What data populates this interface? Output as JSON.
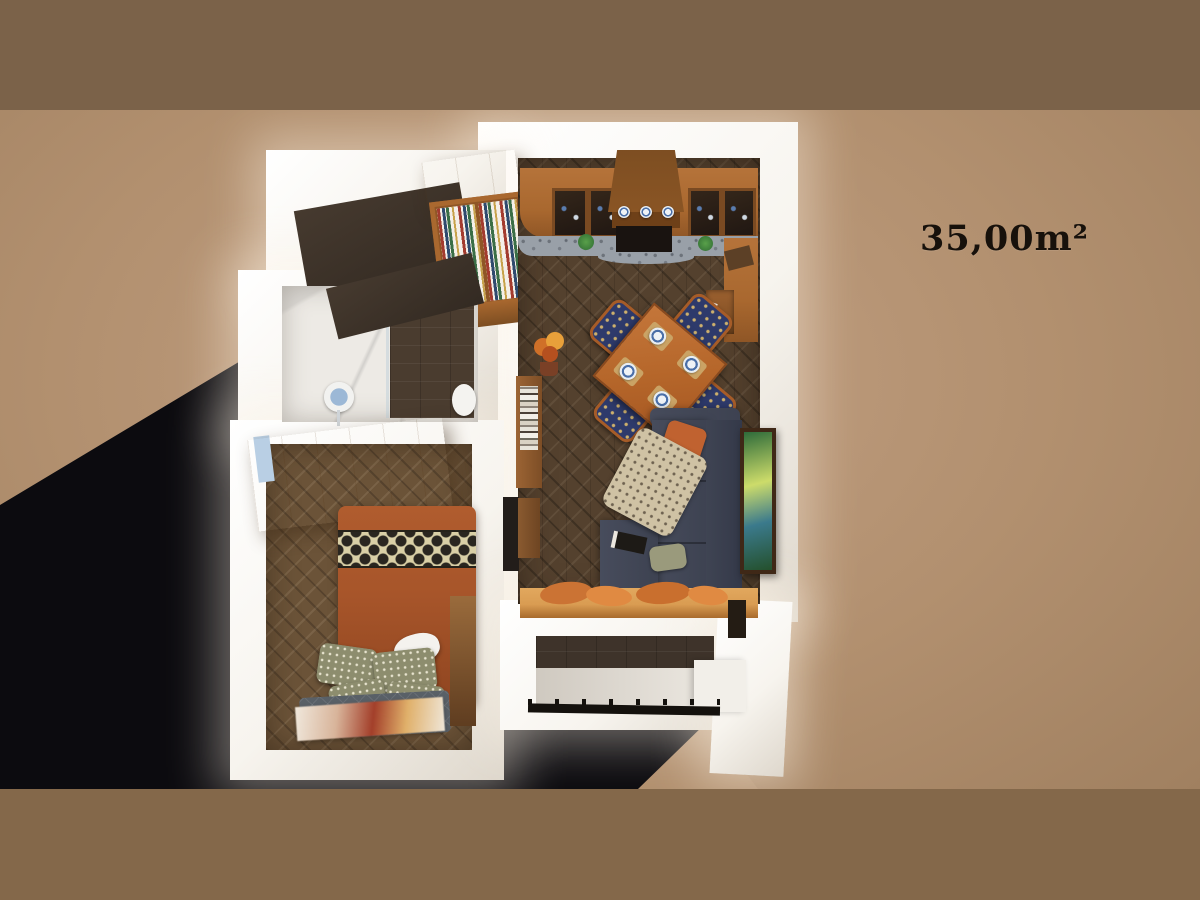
{
  "label": {
    "area": "35,00m²"
  },
  "palette": {
    "band-top": "#7b6249",
    "band-bottom": "#84684a",
    "backdrop": "#b2906f",
    "backdrop-light": "#c2a083",
    "backdrop-dark": "#a08060",
    "shadow": "#0c0b0f",
    "wall-white": "#f7f4ee",
    "wall-shade": "#ded7cc",
    "floor-dark": "#54412e",
    "floor-bedroom": "#6b5338",
    "kitchen-wood": "#a9682f",
    "kitchen-wood-dark": "#8a5524",
    "counter-granite": "#99a0a8",
    "table-wood": "#b5662a",
    "wardrobe-light": "#e9b269",
    "wardrobe-front": "#c9893f",
    "bed-orange": "#a7552a",
    "sofa-gray": "#474c5c",
    "bench-wood": "#d99c52",
    "accent-blue": "#2e3a6b",
    "pillow-olive": "#8d8d6e",
    "text-dark": "#17110b"
  }
}
